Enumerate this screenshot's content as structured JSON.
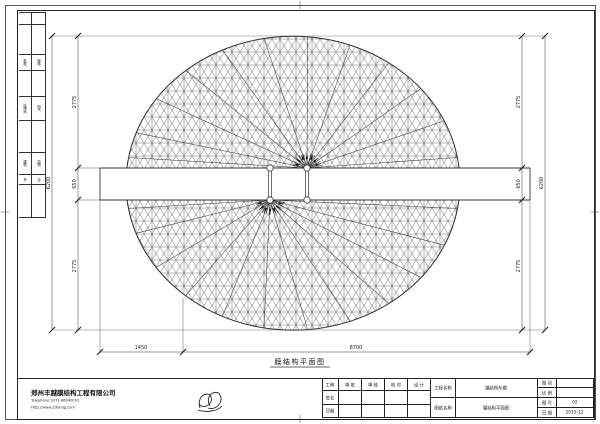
{
  "sheet": {
    "caption": "膜结构平面图"
  },
  "dims": {
    "v_overall": "6200",
    "v_top": "2775",
    "v_mid": "650",
    "v_bot": "2775",
    "h_left": "1450",
    "h_right": "8700"
  },
  "margin_strip": {
    "rows": [
      {
        "a": "",
        "b": ""
      },
      {
        "a": "",
        "b": ""
      },
      {
        "a": "批准",
        "b": "审核"
      },
      {
        "a": "",
        "b": ""
      },
      {
        "a": "给排水",
        "b": "电气"
      },
      {
        "a": "",
        "b": ""
      },
      {
        "a": "建筑",
        "b": "结构"
      },
      {
        "a": "专",
        "b": "业"
      },
      {
        "a": "",
        "b": ""
      }
    ]
  },
  "title_block": {
    "company": {
      "name": "郑州丰越膜结构工程有限公司",
      "tel": "Telephone:0371-66040001",
      "web": "Http://www.zzfymjg.com"
    },
    "sig_table": {
      "headers": [
        "工种",
        "审 定",
        "审 核",
        "校 对",
        "设 计"
      ],
      "row_labels": [
        "签名",
        "日期"
      ]
    },
    "name_table": {
      "project_label": "工程名称",
      "project_value": "膜结构车棚",
      "sheet_label": "图纸名称",
      "sheet_value": "膜结构平面图"
    },
    "info_table": {
      "rows": [
        {
          "label": "图 别",
          "value": ""
        },
        {
          "label": "比 例",
          "value": ""
        },
        {
          "label": "图 号",
          "value": "02"
        },
        {
          "label": "日 期",
          "value": "2015-12"
        }
      ]
    }
  }
}
